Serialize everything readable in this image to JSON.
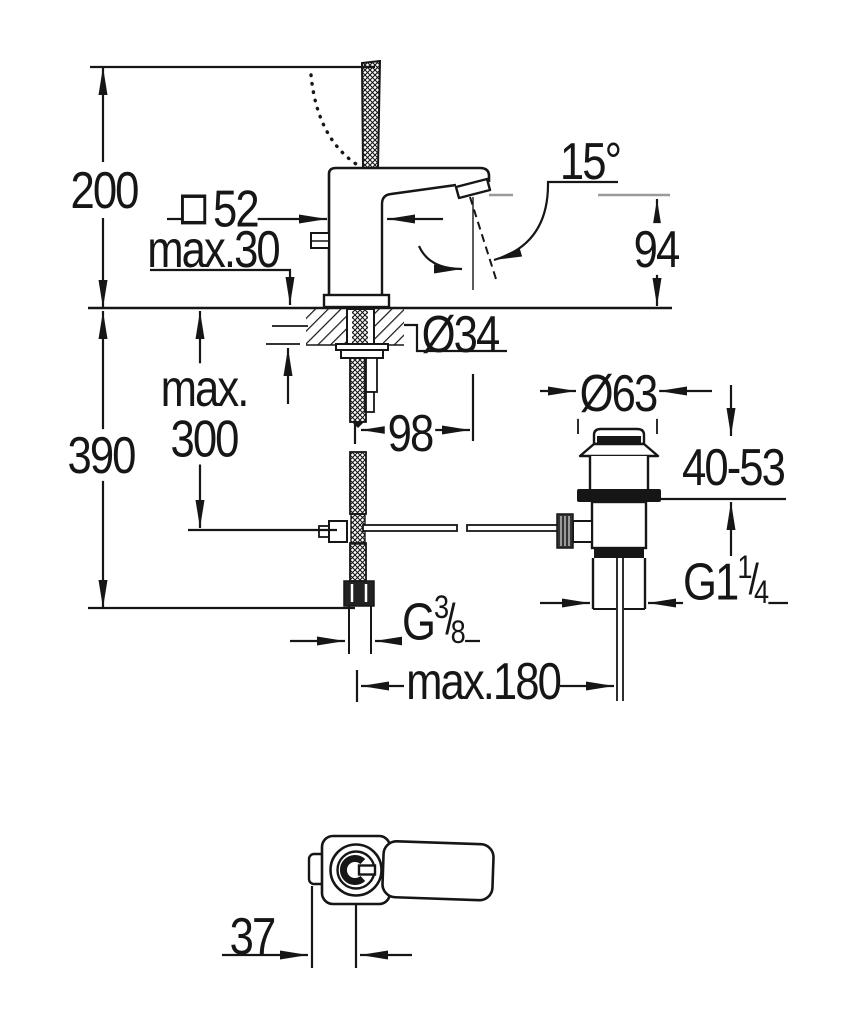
{
  "drawing": {
    "kind": "technical-dimension-drawing",
    "subject": "single-lever basin mixer with pop-up waste, side view and top view",
    "colors": {
      "line": "#161616",
      "reference_gray": "#9a9a9a",
      "background": "#ffffff"
    }
  },
  "labels": {
    "total_height": "200",
    "body_square_size": "52",
    "deck_thickness": "max.30",
    "spout_angle": "15°",
    "spout_outlet_height": "94",
    "hole_diameter": "Ø34",
    "pull_rod_line1": "max.",
    "pull_rod_line2": "300",
    "under_deck_height": "390",
    "spout_reach": "98",
    "waste_flange_diameter": "Ø63",
    "waste_height_range": "40-53",
    "waste_thread_main": "G1",
    "waste_thread_sup": "1",
    "waste_thread_sub": "4",
    "supply_thread_main": "G",
    "supply_thread_sup": "3",
    "supply_thread_sub": "8",
    "fraction_separator": "/",
    "center_distance": "max.180",
    "handle_offset": "37"
  }
}
